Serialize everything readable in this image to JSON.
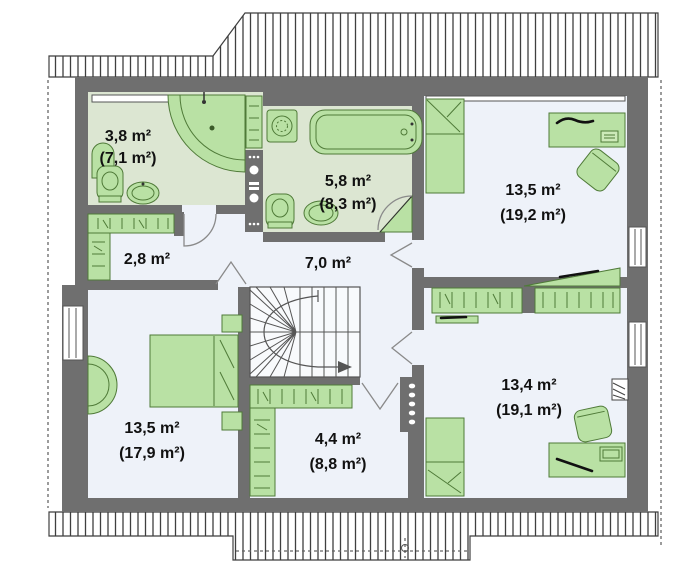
{
  "plan_title": "Attic floor plan",
  "unit": "m²",
  "rooms": {
    "bath_small": {
      "area": "3,8 m²",
      "gross": "(7,1 m²)"
    },
    "bath_main": {
      "area": "5,8 m²",
      "gross": "(8,3 m²)"
    },
    "bedroom_top_right": {
      "area": "13,5 m²",
      "gross": "(19,2 m²)"
    },
    "closet": {
      "area": "2,8 m²"
    },
    "hallway": {
      "area": "7,0 m²"
    },
    "bedroom_bottom_left": {
      "area": "13,5 m²",
      "gross": "(17,9 m²)"
    },
    "wardrobe_room": {
      "area": "4,4 m²",
      "gross": "(8,8 m²)"
    },
    "bedroom_bottom_right": {
      "area": "13,4 m²",
      "gross": "(19,1 m²)"
    }
  },
  "colors": {
    "wall": "#6f6f6f",
    "bath_floor": "#dce6d2",
    "room_floor": "#eef2f9",
    "furniture": "#b9e1a4",
    "furniture_border": "#4f7a38",
    "roof_hatch": "#3f3f3f",
    "text": "#111111"
  }
}
